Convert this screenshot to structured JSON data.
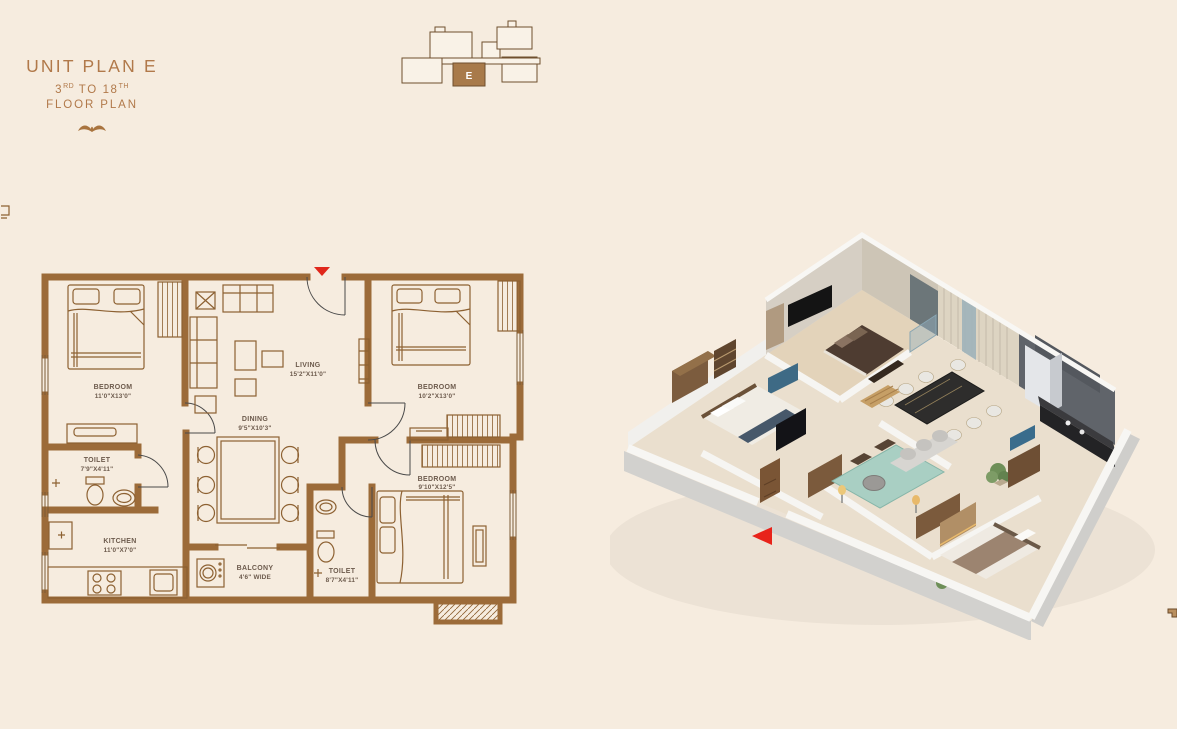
{
  "page": {
    "background": "#f6ecdf"
  },
  "header": {
    "title": "UNIT PLAN E",
    "floors": {
      "prefix": "3",
      "sup1": "RD",
      "mid": " TO 18",
      "sup2": "TH"
    },
    "plan_label": "FLOOR PLAN"
  },
  "key_plan": {
    "unit_letter": "E"
  },
  "plan2d": {
    "rooms": [
      {
        "name": "BEDROOM",
        "dims": "11'0\"X13'0\""
      },
      {
        "name": "LIVING",
        "dims": "15'2\"X11'0\""
      },
      {
        "name": "BEDROOM",
        "dims": "10'2\"X13'0\""
      },
      {
        "name": "DINING",
        "dims": "9'5\"X10'3\""
      },
      {
        "name": "TOILET",
        "dims": "7'9\"X4'11\""
      },
      {
        "name": "KITCHEN",
        "dims": "11'0\"X7'0\""
      },
      {
        "name": "BALCONY",
        "dims": "4'6\" WIDE"
      },
      {
        "name": "TOILET",
        "dims": "8'7\"X4'11\""
      },
      {
        "name": "BEDROOM",
        "dims": "9'10\"X12'5\""
      }
    ]
  },
  "colors": {
    "accent_brown": "#b1794a",
    "wall_brown": "#9c6b39",
    "furniture_line": "#8d6132",
    "label_grey_brown": "#6d5b4d",
    "entry_marker_red": "#e0271b",
    "keyplan_unit_fill": "#a87a4a",
    "rug_teal": "#a9cfc3"
  }
}
